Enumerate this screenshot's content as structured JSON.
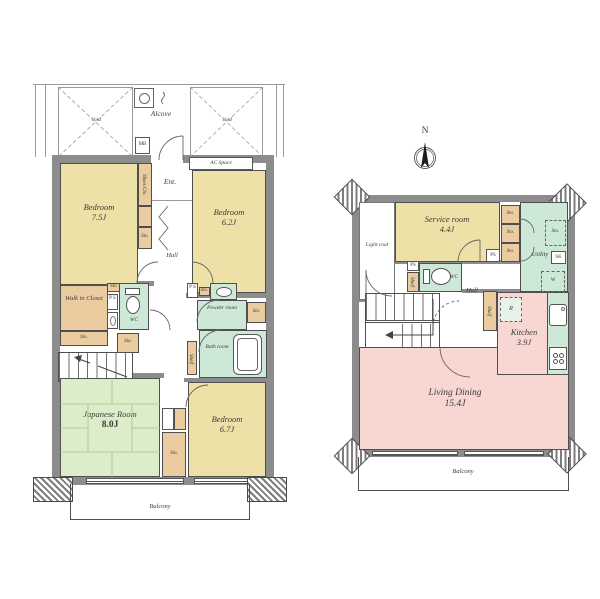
{
  "labels": {
    "void": "Void",
    "sto": "Sto.",
    "ps": "PS",
    "ps_stack": "P S",
    "shelf": "Shelf",
    "wc": "WC",
    "hall": "Hall",
    "balcony": "Balcony"
  },
  "floor1": {
    "alcove": "Alcove",
    "mb": "MB",
    "ac_space": "AC Space",
    "entrance": "Ent.",
    "shoes_closet": "Shoes Clo.",
    "bedroom_a_name": "Bedroom",
    "bedroom_a_size": "7.5J",
    "bedroom_b_name": "Bedroom",
    "bedroom_b_size": "6.2J",
    "bedroom_c_name": "Bedroom",
    "bedroom_c_size": "6.7J",
    "walk_in_closet": "Walk in Closet",
    "powder_room": "Powder room",
    "bath_room": "Bath room",
    "japanese_room_name": "Japanese Room",
    "japanese_room_size": "8.0J"
  },
  "floor2": {
    "compass_north": "N",
    "light_court": "Light coat",
    "service_room_name": "Service room",
    "service_room_size": "4.4J",
    "utility": "Utility",
    "sink_sk": "SK",
    "washer_w": "W",
    "refrigerator_r": "R",
    "kitchen_name": "Kitchen",
    "kitchen_size": "3.9J",
    "living_dining_name": "Living Dining",
    "living_dining_size": "15.4J"
  },
  "colors": {
    "room_tan": "#EDE1A8",
    "closet_tan": "#EACCA0",
    "wet_area_green": "#CDE8D6",
    "tatami_green": "#DCEDC9",
    "ldk_pink": "#F8D7D3",
    "wall_gray": "#8C8C8C"
  }
}
